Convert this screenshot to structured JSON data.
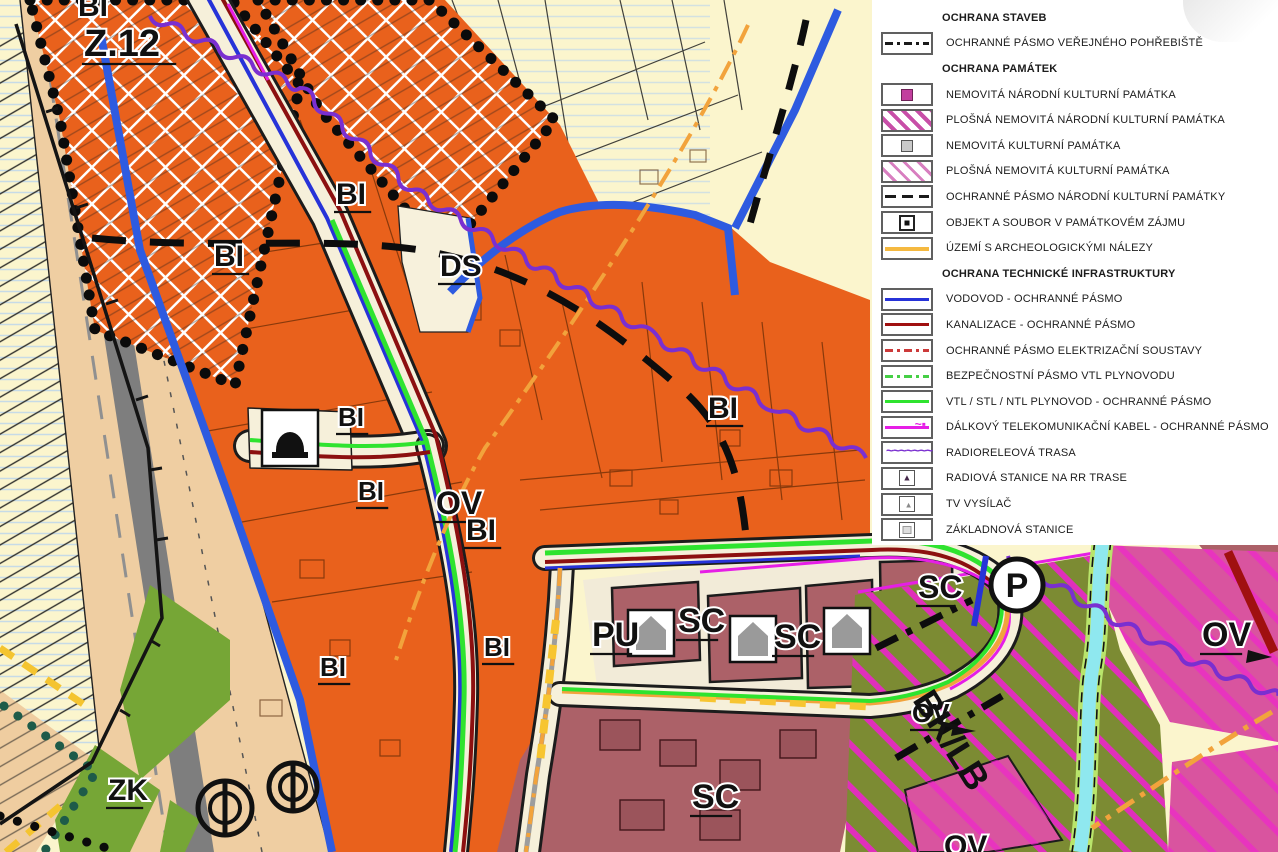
{
  "legend": {
    "rows": [
      {
        "type": "header",
        "label": "OCHRANA STAVEB"
      },
      {
        "type": "item",
        "symbol": "line dashdot-black",
        "label": "OCHRANNÉ PÁSMO VEŘEJNÉHO POHŘEBIŠTĚ"
      },
      {
        "type": "header",
        "label": "OCHRANA PAMÁTEK"
      },
      {
        "type": "item",
        "symbol": "box-magenta-square",
        "label": "NEMOVITÁ NÁRODNÍ KULTURNÍ PAMÁTKA"
      },
      {
        "type": "item",
        "symbol": "hatch-magenta",
        "label": "PLOŠNÁ NEMOVITÁ NÁRODNÍ KULTURNÍ PAMÁTKA"
      },
      {
        "type": "item",
        "symbol": "box-gray-square",
        "label": "NEMOVITÁ KULTURNÍ PAMÁTKA"
      },
      {
        "type": "item",
        "symbol": "hatch-magenta-light",
        "label": "PLOŠNÁ NEMOVITÁ KULTURNÍ PAMÁTKA"
      },
      {
        "type": "item",
        "symbol": "line dash-black",
        "label": "OCHRANNÉ PÁSMO NÁRODNÍ KULTURNÍ PAMÁTKY"
      },
      {
        "type": "item",
        "symbol": "box-black-dot",
        "label": "OBJEKT A SOUBOR V PAMÁTKOVÉM ZÁJMU"
      },
      {
        "type": "item",
        "symbol": "line line-orange",
        "label": "ÚZEMÍ S ARCHEOLOGICKÝMI NÁLEZY"
      },
      {
        "type": "header",
        "label": "OCHRANA TECHNICKÉ INFRASTRUKTURY"
      },
      {
        "type": "item",
        "symbol": "line line-blue",
        "label": "VODOVOD - OCHRANNÉ PÁSMO"
      },
      {
        "type": "item",
        "symbol": "line line-darkred",
        "label": "KANALIZACE - OCHRANNÉ PÁSMO"
      },
      {
        "type": "item",
        "symbol": "line dashdot-red",
        "label": "OCHRANNÉ PÁSMO ELEKTRIZAČNÍ SOUSTAVY"
      },
      {
        "type": "item",
        "symbol": "line dashdot-green",
        "label": "BEZPEČNOSTNÍ PÁSMO VTL PLYNOVODU"
      },
      {
        "type": "item",
        "symbol": "line line-green",
        "label": "VTL / STL / NTL PLYNOVOD - OCHRANNÉ PÁSMO"
      },
      {
        "type": "item",
        "symbol": "line-magenta-wave",
        "label": "DÁLKOVÝ TELEKOMUNIKAČNÍ KABEL - OCHRANNÉ PÁSMO"
      },
      {
        "type": "item",
        "symbol": "wavy-purple",
        "label": "RADIORELEOVÁ TRASA"
      },
      {
        "type": "item",
        "symbol": "box-antenna",
        "label": "RADIOVÁ STANICE NA RR TRASE"
      },
      {
        "type": "item",
        "symbol": "box-tv",
        "label": "TV VYSÍLAČ"
      },
      {
        "type": "item",
        "symbol": "box-base",
        "label": "ZÁKLADNOVÁ STANICE"
      }
    ]
  },
  "map": {
    "labels": [
      {
        "text": "BI",
        "x": 78,
        "y": 16,
        "size": 30,
        "underline": false
      },
      {
        "text": "Z.12",
        "x": 84,
        "y": 56,
        "size": 38,
        "underline": true
      },
      {
        "text": "BI",
        "x": 214,
        "y": 266,
        "size": 30,
        "underline": true
      },
      {
        "text": "BI",
        "x": 336,
        "y": 204,
        "size": 30,
        "underline": true
      },
      {
        "text": "DS",
        "x": 440,
        "y": 276,
        "size": 30,
        "underline": true
      },
      {
        "text": "BI",
        "x": 708,
        "y": 418,
        "size": 30,
        "underline": true
      },
      {
        "text": "BI",
        "x": 338,
        "y": 426,
        "size": 26,
        "underline": true
      },
      {
        "text": "BI",
        "x": 358,
        "y": 500,
        "size": 26,
        "underline": true
      },
      {
        "text": "OV",
        "x": 436,
        "y": 514,
        "size": 32,
        "underline": true
      },
      {
        "text": "BI",
        "x": 466,
        "y": 540,
        "size": 30,
        "underline": true
      },
      {
        "text": "BI",
        "x": 484,
        "y": 656,
        "size": 26,
        "underline": true
      },
      {
        "text": "BI",
        "x": 320,
        "y": 676,
        "size": 26,
        "underline": true
      },
      {
        "text": "PU",
        "x": 592,
        "y": 646,
        "size": 34,
        "underline": true
      },
      {
        "text": "SC",
        "x": 678,
        "y": 632,
        "size": 34,
        "underline": true
      },
      {
        "text": "SC",
        "x": 774,
        "y": 648,
        "size": 34,
        "underline": true
      },
      {
        "text": "SC",
        "x": 918,
        "y": 598,
        "size": 32,
        "underline": true
      },
      {
        "text": "SC",
        "x": 692,
        "y": 808,
        "size": 34,
        "underline": true
      },
      {
        "text": "ZK",
        "x": 108,
        "y": 800,
        "size": 30,
        "underline": true
      },
      {
        "text": "OV",
        "x": 912,
        "y": 722,
        "size": 26,
        "underline": true
      },
      {
        "text": "OV",
        "x": 1202,
        "y": 646,
        "size": 34,
        "underline": true
      },
      {
        "text": "OV",
        "x": 944,
        "y": 856,
        "size": 30,
        "underline": false
      },
      {
        "text": "BK/LB",
        "x": 912,
        "y": 700,
        "size": 36,
        "rotate": 58,
        "halo": false,
        "underline": false
      }
    ],
    "icons": {
      "parking": "P",
      "church-monument": "bell-shape",
      "house-monument": "house-shape",
      "well": "circled-vertical-bar"
    },
    "colors": {
      "bi_orange": "#E9611C",
      "reserve_cream": "#FBF5CD",
      "corridor_tan": "#EFCEA2",
      "road_gray": "#7E7E7E",
      "sc_maroon": "#AC6168",
      "ov_pink": "#D9549F",
      "zk_green": "#76A636",
      "olive_green": "#7C8B33",
      "water_cyan": "#8FE8EF",
      "boundary_blue": "#2E5BE0",
      "vodovod_blue": "#2733D8",
      "kanalizace_red": "#8C1010",
      "plynovod_green": "#2FE32F",
      "telecom_magenta": "#E61EE6",
      "radiorele_purple": "#7A2FD0",
      "archeo_orange": "#F2A33C"
    }
  }
}
